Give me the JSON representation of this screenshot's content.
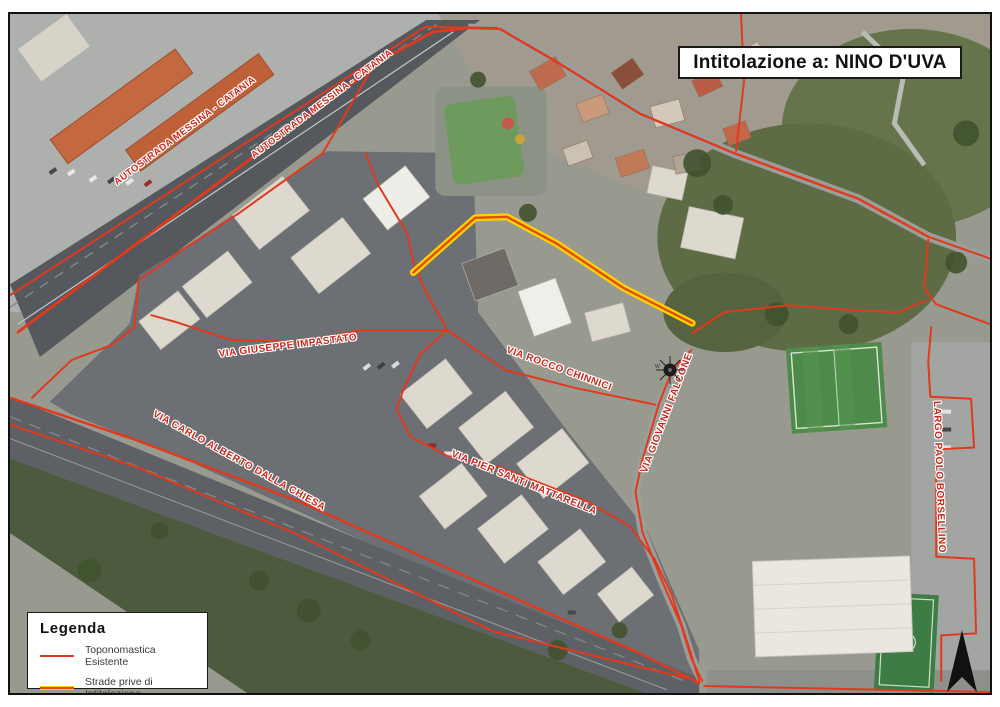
{
  "title_box": {
    "text": "Intitolazione a: NINO D'UVA"
  },
  "street_labels": [
    {
      "id": "autostrada-1",
      "name": "AUTOSTRADA MESSINA - CATANIA"
    },
    {
      "id": "autostrada-2",
      "name": "AUTOSTRADA MESSINA - CATANIA"
    },
    {
      "id": "impastato",
      "name": "VIA GIUSEPPE IMPASTATO"
    },
    {
      "id": "carlo-alberto",
      "name": "VIA CARLO ALBERTO DALLA CHIESA"
    },
    {
      "id": "chinnici",
      "name": "VIA ROCCO CHINNICI"
    },
    {
      "id": "mattarella",
      "name": "VIA PIER SANTI MATTARELLA"
    },
    {
      "id": "falcone",
      "name": "VIA GIOVANNI FALCONE"
    },
    {
      "id": "borsellino",
      "name": "LARGO PAOLO BORSELLINO"
    }
  ],
  "legend": {
    "title": "Legenda",
    "items": [
      {
        "label": "Toponomastica Esistente",
        "color": "#e2391d"
      },
      {
        "label": "Strade prive di Intitolazione",
        "color": "#e24d0f",
        "outline_color": "#ffd400"
      }
    ]
  },
  "overlay_colors": {
    "existing_road": "#e2391d",
    "unnamed_road_core": "#e24d0f",
    "unnamed_road_outline": "#ffd400",
    "street_label_text": "#c8291c"
  },
  "compass_marker": {
    "west_label": "W"
  }
}
